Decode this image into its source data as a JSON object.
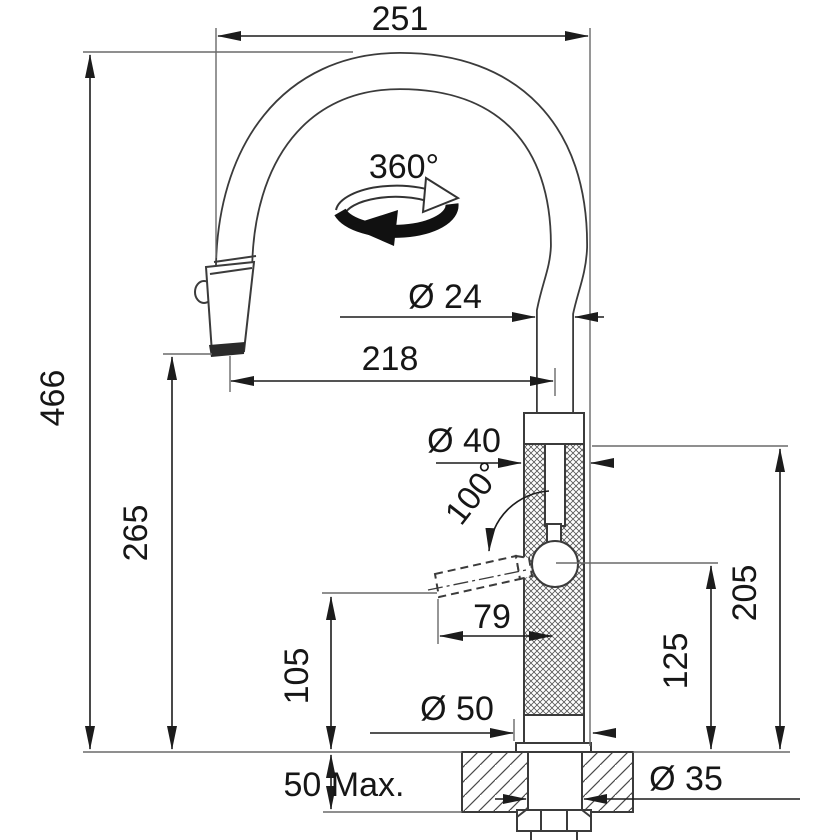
{
  "drawing": {
    "title": "Kitchen faucet dimensional diagram",
    "unit": "mm",
    "line_color": "#3b3b3b",
    "dim_color": "#1c1c1c"
  },
  "labels": {
    "spout_reach": "251",
    "swivel_angle": "360°",
    "spout_diameter": "Ø 24",
    "outlet_reach": "218",
    "overall_height": "466",
    "outlet_height": "265",
    "body_diameter": "Ø 40",
    "handle_swing_angle": "100°",
    "handle_reach": "79",
    "handle_bottom_height": "105",
    "handle_pivot_height": "125",
    "body_top_height": "205",
    "base_diameter": "Ø 50",
    "max_deck_thickness": "50 Max.",
    "mounting_hole_diameter": "Ø 35"
  }
}
